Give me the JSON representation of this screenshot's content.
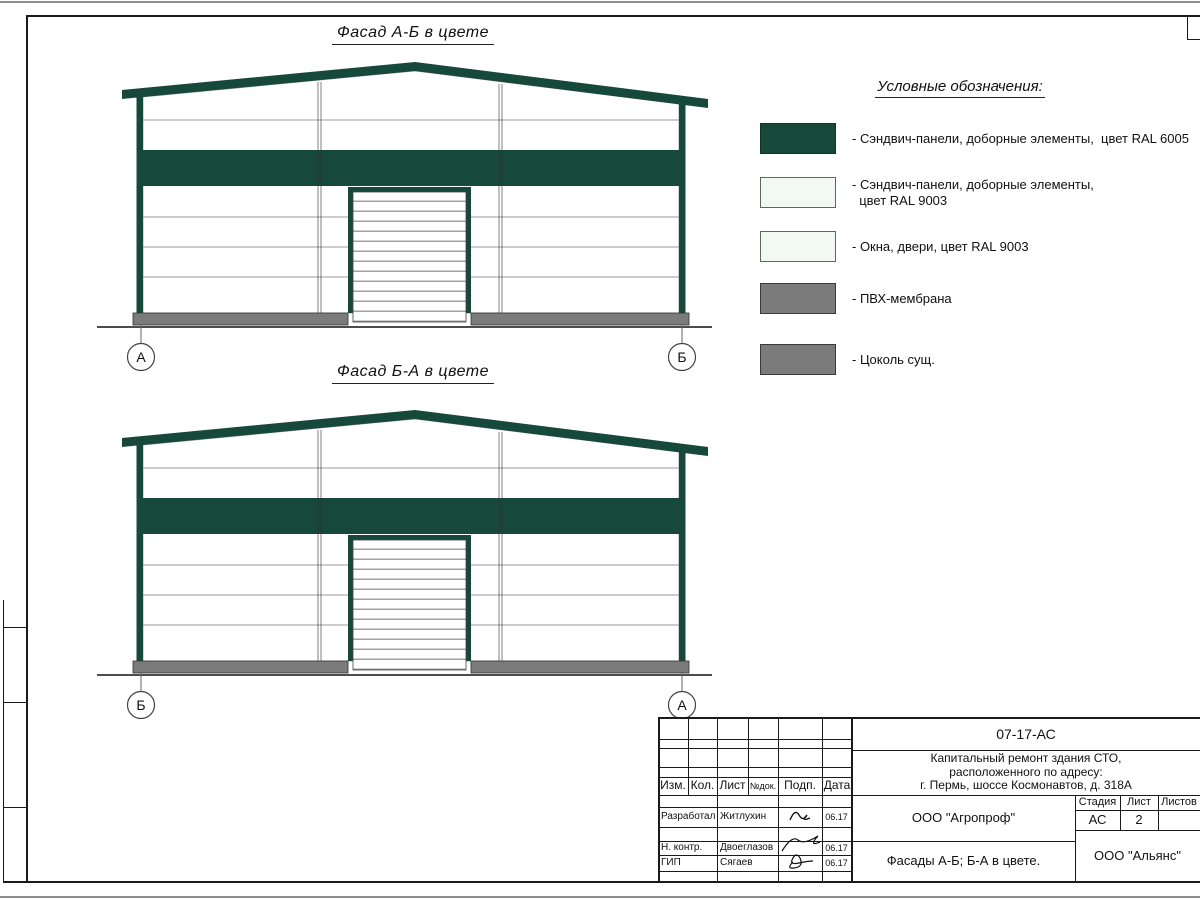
{
  "colors": {
    "ral6005": "#17493A",
    "ral9003": "#F2F8F2",
    "membrane_gray": "#7B7B7B"
  },
  "facades": [
    {
      "title": "Фасад А-Б в цвете",
      "left_axis": "А",
      "right_axis": "Б"
    },
    {
      "title": "Фасад Б-А в цвете",
      "left_axis": "Б",
      "right_axis": "А"
    }
  ],
  "legend": {
    "heading": "Условные обозначения:",
    "items": [
      {
        "color": "#17493A",
        "label": "- Сэндвич-панели, доборные элементы,  цвет RAL 6005"
      },
      {
        "color": "#F2F8F2",
        "label": "- Сэндвич-панели, доборные элементы,\n  цвет RAL 9003"
      },
      {
        "color": "#F2F8F2",
        "label": "- Окна, двери, цвет RAL 9003"
      },
      {
        "color": "#7B7B7B",
        "label": "- ПВХ-мембрана"
      },
      {
        "color": "#7B7B7B",
        "label": "- Цоколь сущ."
      }
    ]
  },
  "title_block": {
    "doc_number": "07-17-АС",
    "project_lines": [
      "Капитальный ремонт здания СТО,",
      "расположенного по адресу:",
      "г. Пермь, шоссе Космонавтов, д. 318А"
    ],
    "revision_columns": [
      "Изм.",
      "Кол.",
      "Лист",
      "№док.",
      "Подп.",
      "Дата"
    ],
    "signature_rows": [
      {
        "role": "Разработал",
        "name": "Житлухин",
        "date": "06.17"
      },
      {
        "role": "Н. контр.",
        "name": "Двоеглазов",
        "date": "06.17"
      },
      {
        "role": "ГИП",
        "name": "Сягаев",
        "date": "06.17"
      }
    ],
    "designer_org": "ООО \"Агропроф\"",
    "drawing_title": "Фасады А-Б; Б-А в цвете.",
    "client_org": "ООО \"Альянс\"",
    "stage_header": "Стадия",
    "sheet_header": "Лист",
    "sheets_header": "Листов",
    "stage_value": "АС",
    "sheet_value": "2",
    "sheets_value": ""
  }
}
